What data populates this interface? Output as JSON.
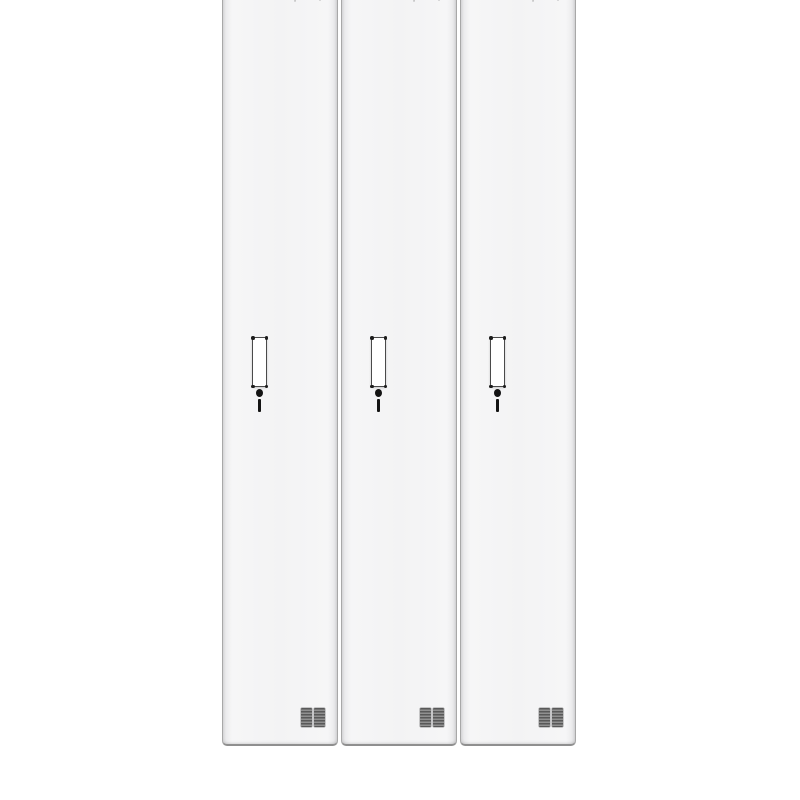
{
  "page": {
    "background": "#ffffff"
  },
  "cabinet": {
    "name": "three-door-locker-cabinet",
    "description": "Front view of a white steel locker cabinet with three tall vertical doors on a white background, top edge cropped out of frame",
    "door_count": 3,
    "colors": {
      "page-bg": "#ffffff",
      "door-face": "#f3f3f4",
      "door-face-shadow": "#e6e6e8",
      "door-edge": "#a8a8a8",
      "bottom-edge": "#8f8f8f",
      "handle-fill": "#ffffff",
      "handle-border": "#4a4a4a",
      "screw": "#1c1c1c",
      "keyhole": "#141414",
      "vent-dark": "#595959",
      "vent-light": "#909090",
      "emblem": "#c2c2c2"
    },
    "doors": [
      {
        "id": "door-1",
        "label": "left locker door"
      },
      {
        "id": "door-2",
        "label": "middle locker door"
      },
      {
        "id": "door-3",
        "label": "right locker door"
      }
    ],
    "door_components": [
      "brand-emblem",
      "recessed-handle",
      "corner-screws",
      "keyhole-lock",
      "ventilation-grille"
    ]
  }
}
